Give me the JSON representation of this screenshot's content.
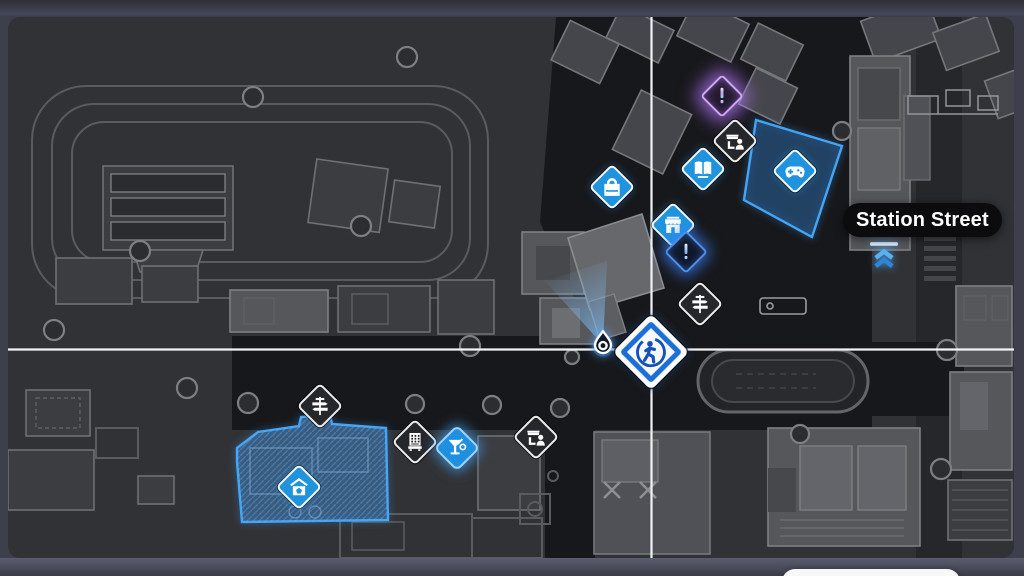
{
  "street_label": {
    "text": "Station Street"
  },
  "colors": {
    "accent_blue": "#1f93dd",
    "marker_dark": "#26272b",
    "quest_purple_glow": "#cfa6f5",
    "quest_blue_glow": "#4f8fe8",
    "map_background": "#313235",
    "road_black": "#17181b",
    "crosshair": "#f2f2f3",
    "zone_highlight": "#43a5f5",
    "frame": "#3d3f4c"
  },
  "map": {
    "crosshair": {
      "x": 651,
      "y": 350
    },
    "highlighted_buildings": [
      "arcade-building",
      "home-building"
    ],
    "markers": [
      {
        "id": "view-cone",
        "icon": "cone",
        "variant": "cone",
        "x": 589,
        "y": 303,
        "interactable": false
      },
      {
        "id": "player-pin",
        "icon": "pin",
        "variant": "flat",
        "x": 603,
        "y": 344,
        "interactable": false
      },
      {
        "id": "metro-entrance",
        "icon": "metro",
        "variant": "flat",
        "x": 884,
        "y": 255,
        "interactable": false
      },
      {
        "id": "quest-purple",
        "icon": "exclam-p",
        "variant": "glow-purple",
        "x": 722,
        "y": 96
      },
      {
        "id": "street-vendor-upper",
        "icon": "shop-npc",
        "variant": "dark",
        "x": 735,
        "y": 141
      },
      {
        "id": "bookstore",
        "icon": "book",
        "variant": "blue",
        "x": 703,
        "y": 169
      },
      {
        "id": "arcade",
        "icon": "gamepad",
        "variant": "blue",
        "x": 795,
        "y": 171
      },
      {
        "id": "general-store",
        "icon": "bag",
        "variant": "blue",
        "x": 612,
        "y": 187
      },
      {
        "id": "storefront",
        "icon": "shop",
        "variant": "blue",
        "x": 673,
        "y": 225
      },
      {
        "id": "quest-blue",
        "icon": "exclam-b",
        "variant": "glow-blue",
        "x": 686,
        "y": 252
      },
      {
        "id": "signpost-north",
        "icon": "signpost",
        "variant": "dark",
        "x": 700,
        "y": 304
      },
      {
        "id": "fast-travel-hub",
        "icon": "runner",
        "variant": "hub",
        "x": 651,
        "y": 352
      },
      {
        "id": "signpost-west",
        "icon": "signpost",
        "variant": "dark",
        "x": 320,
        "y": 406
      },
      {
        "id": "vending-machine",
        "icon": "vending",
        "variant": "dark",
        "x": 415,
        "y": 442
      },
      {
        "id": "cocktail-bar",
        "icon": "cocktail",
        "variant": "blue-glow",
        "x": 457,
        "y": 448
      },
      {
        "id": "street-vendor-lower",
        "icon": "shop-npc",
        "variant": "dark",
        "x": 536,
        "y": 437
      },
      {
        "id": "home-base",
        "icon": "home",
        "variant": "blue",
        "x": 299,
        "y": 487
      }
    ]
  }
}
